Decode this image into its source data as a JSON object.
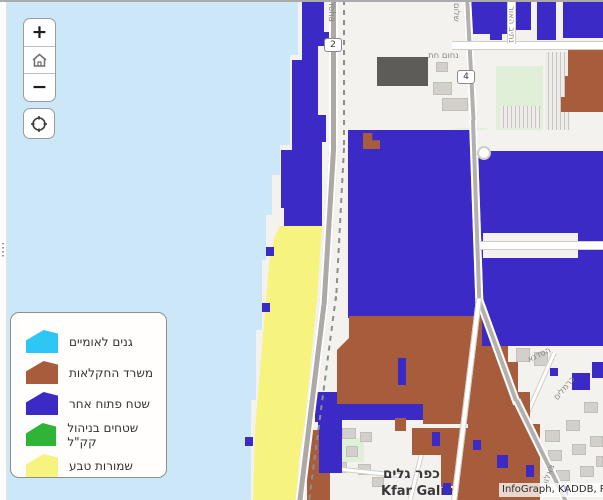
{
  "colors": {
    "sea": "#CBE7F8",
    "land": "#F4F2EE",
    "overlay-blue": "#3B2AC6",
    "overlay-brown": "#A75C3B",
    "overlay-yellow": "#F6F47E",
    "overlay-cyan": "#2EC6F5",
    "overlay-green": "#2FB438",
    "road-major": "#ACA9A6",
    "park": "#DFEFD8",
    "building": "#D3D0CC",
    "building-dark": "#5E5C58"
  },
  "controls": {
    "zoom_in_label": "+",
    "zoom_out_label": "−"
  },
  "legend": {
    "items": [
      {
        "label": "גנים לאומיים",
        "color": "#2EC6F5"
      },
      {
        "label": "משרד החקלאות",
        "color": "#A75C3B"
      },
      {
        "label": "שטח פתוח אחר",
        "color": "#3B2AC6"
      },
      {
        "label": "שטחים בניהול קק\"ל",
        "color": "#2FB438"
      },
      {
        "label": "שמורות טבע",
        "color": "#F6F47E"
      }
    ]
  },
  "map": {
    "shields": [
      {
        "number": "2"
      },
      {
        "number": "4"
      }
    ],
    "street_labels": {
      "yoha": "Yoha",
      "netiv_haor": "נתיב האור",
      "nahum_het": "נחום חת",
      "shalom": "שלום",
      "hasadna": "הסדנא",
      "karmelim": "כרמלים",
      "tsalon": "צאלון"
    },
    "place": {
      "hebrew": "כפר גלים",
      "latin": "Kfar Galim"
    },
    "attribution": "InfoGraph, KADDB, RJ"
  }
}
